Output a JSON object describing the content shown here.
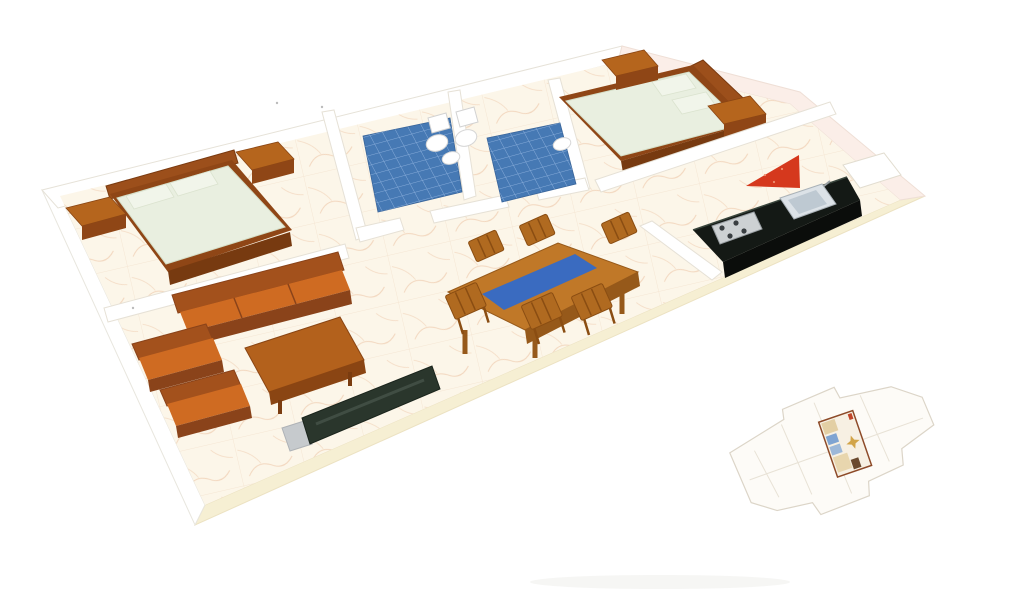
{
  "meta": {
    "title": "3D isometric cutaway rendering of a 2-bedroom apartment",
    "domain": "architectural-visualization"
  },
  "colors": {
    "background": "#ffffff",
    "floor": "#fcf6e9",
    "outer_face": "#f6efd3",
    "wall": "#ffffff",
    "wall_pink": "#fbeee8",
    "tile_blue": "#4679b4",
    "fixture_white": "#ffffff",
    "wood_dark": "#8f4616",
    "wood": "#9c4f1b",
    "wood_light": "#b5651d",
    "mattress": "#e9efe0",
    "pillow": "#f1f5ea",
    "sofa_cushion": "#cf6b22",
    "sofa_frame": "#8a431a",
    "coffee_table": "#b3611c",
    "dining_table": "#c07828",
    "dining_table_side": "#96591a",
    "chair_wood": "#b06a20",
    "runner_blue": "#3a6bc0",
    "counter_black": "#141915",
    "counter_front": "#0b0d0b",
    "steel": "#cdd1d3",
    "sink_steel": "#dce2e7",
    "sink_basin": "#bec9d2",
    "red_granite": "#d5381d",
    "tv_dark": "#2a362c",
    "tv_base": "#c6cacd",
    "inset_fill": "#fdfbf7",
    "inset_outline": "#dcd5c8",
    "unit_border": "#8d4a28",
    "unit_room_tan": "#e3cfa4",
    "unit_room_blue": "#7fa4d2",
    "unit_star": "#d2a448"
  },
  "scene": {
    "view": "elevated isometric cutaway, roof removed",
    "rooms": [
      {
        "id": "bedroom-1",
        "furniture": [
          "double-bed",
          "two-pillows",
          "headboard",
          "nightstand-left",
          "nightstand-right"
        ]
      },
      {
        "id": "bathroom-1",
        "floor": "blue-tile",
        "furniture": [
          "toilet",
          "wash-basin"
        ]
      },
      {
        "id": "bathroom-2",
        "floor": "blue-tile",
        "furniture": [
          "toilet",
          "wash-basin"
        ]
      },
      {
        "id": "bedroom-2",
        "furniture": [
          "double-bed",
          "two-pillows",
          "headboard",
          "nightstand-left",
          "nightstand-right"
        ]
      },
      {
        "id": "kitchen",
        "furniture": [
          "black-granite-counter",
          "gas-stove-4-burner",
          "steel-sink",
          "red-granite-platform",
          "white-platform"
        ]
      },
      {
        "id": "dining-area",
        "furniture": [
          "wooden-dining-table",
          "blue-table-runner",
          "six-dining-chairs"
        ]
      },
      {
        "id": "living-room",
        "furniture": [
          "three-seater-sofa",
          "single-sofa-1",
          "single-sofa-2",
          "coffee-table",
          "flat-tv-panel"
        ]
      }
    ],
    "inset": {
      "id": "key-plan",
      "description": "building floor-plate outline with the rendered unit highlighted"
    }
  }
}
